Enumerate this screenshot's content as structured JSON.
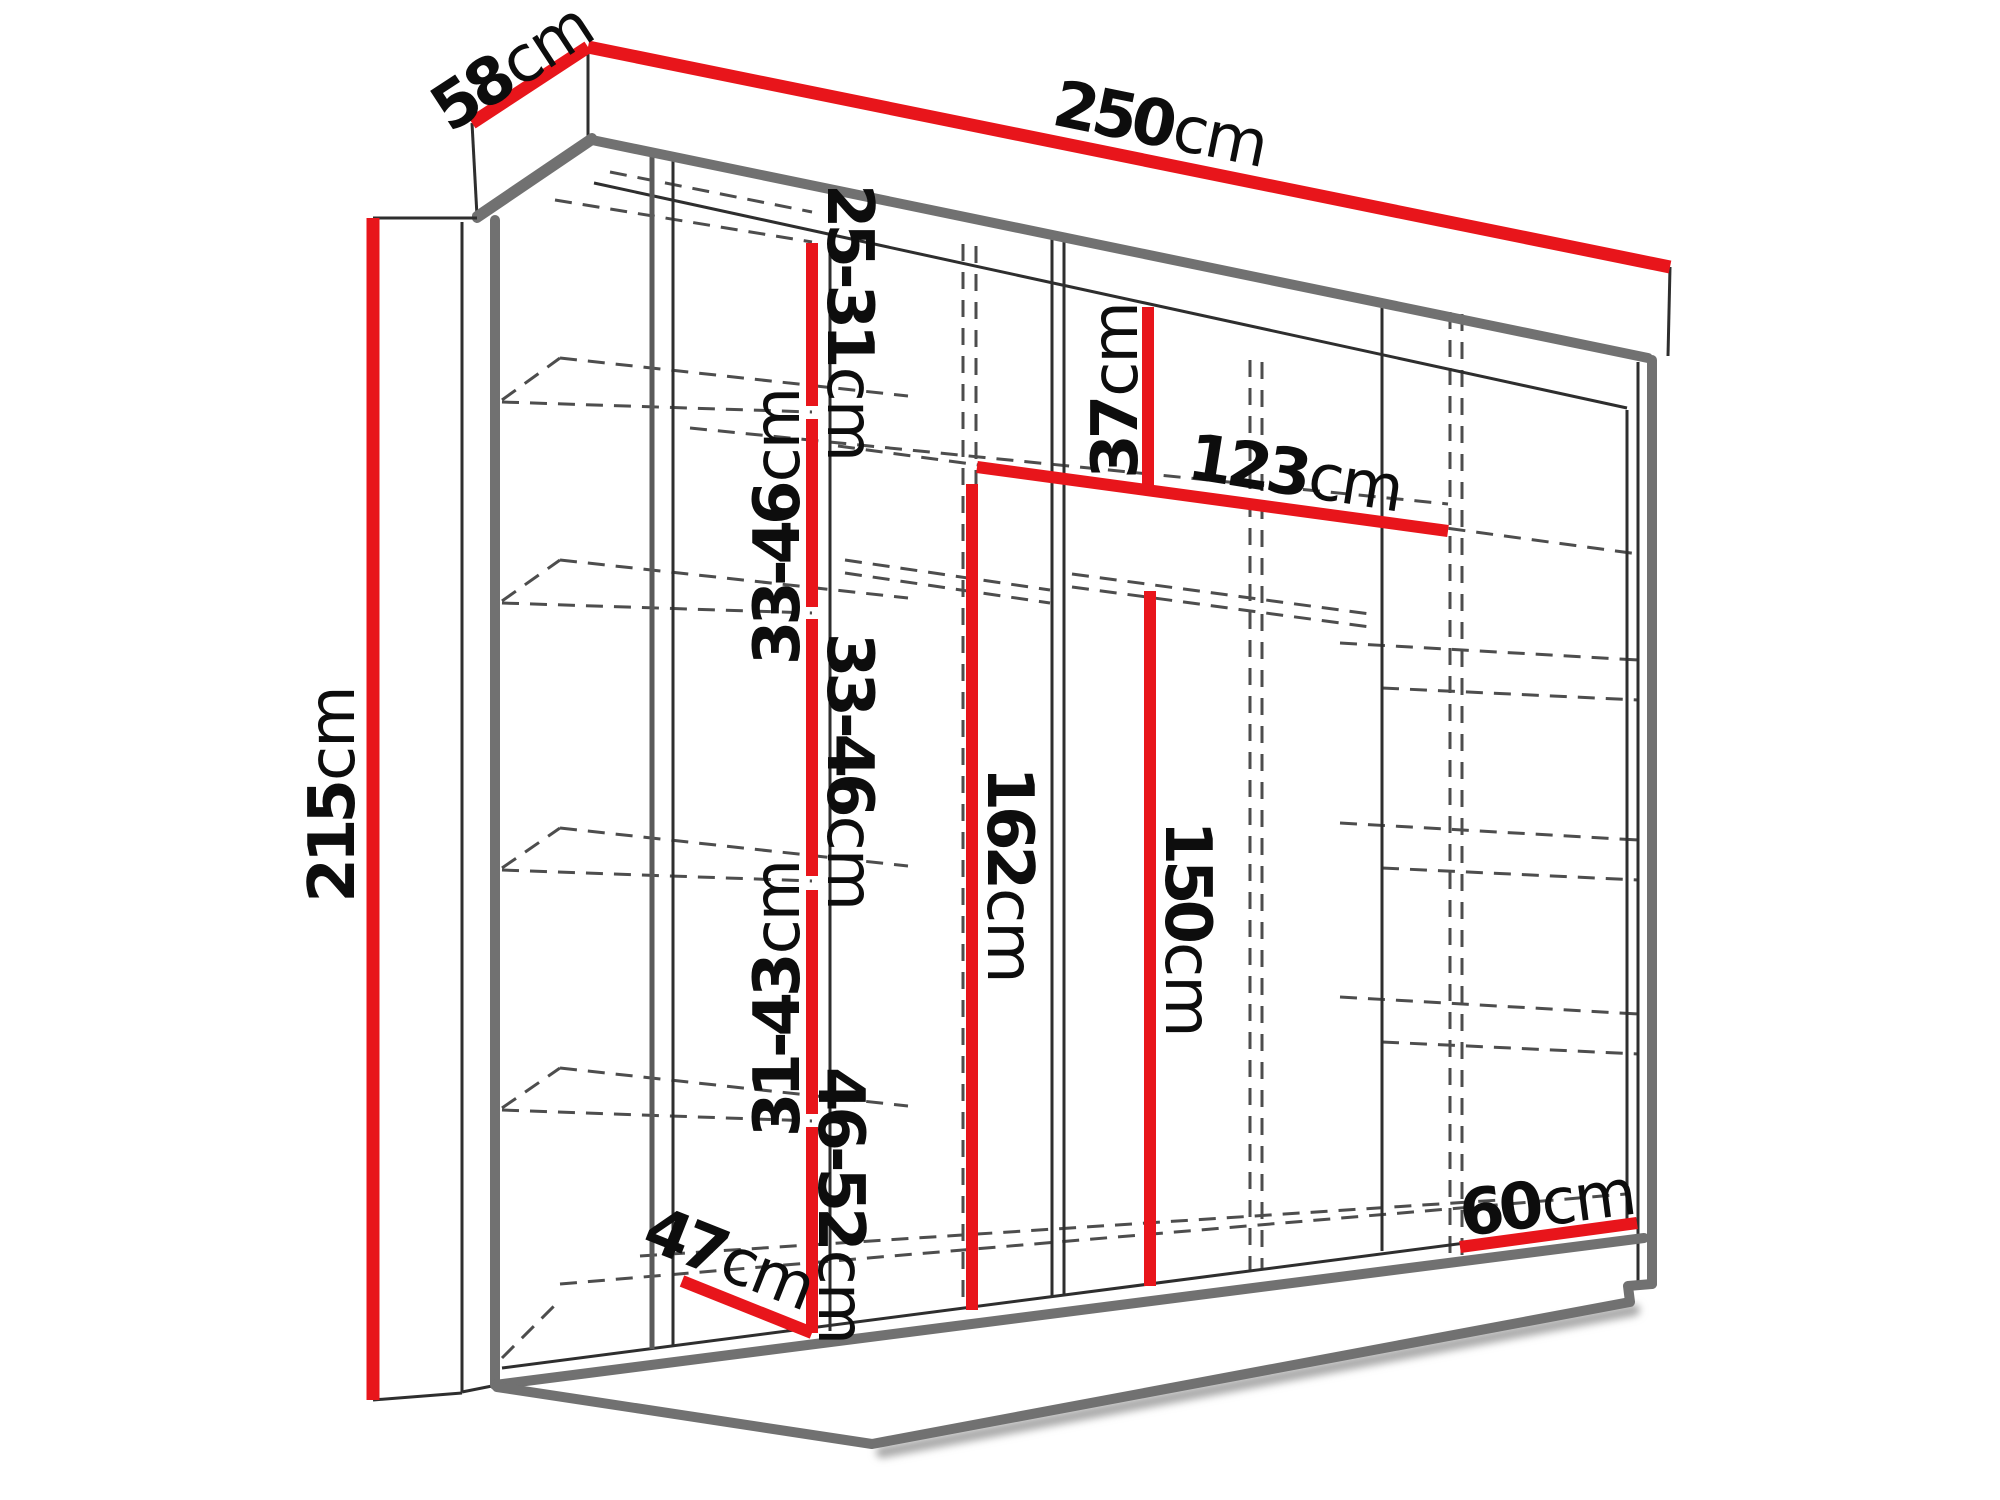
{
  "title": "Sliding wardrobe dimension diagram",
  "unit": "cm",
  "colors": {
    "dimension_line": "#e8151b",
    "structure_thick": "#717171",
    "structure_thin": "#2e2e2e",
    "dashed_line": "#4d4d4d",
    "label_text": "#0d0d0d",
    "background": "#ffffff"
  },
  "dims": {
    "top_depth": {
      "value": "58",
      "unit": "cm"
    },
    "top_width": {
      "value": "250",
      "unit": "cm"
    },
    "side_height": {
      "value": "215",
      "unit": "cm"
    },
    "left_gap_1": {
      "value": "25-31",
      "unit": "cm"
    },
    "left_gap_2": {
      "value": "33-46",
      "unit": "cm"
    },
    "left_gap_3": {
      "value": "33-46",
      "unit": "cm"
    },
    "left_gap_4": {
      "value": "31-43",
      "unit": "cm"
    },
    "left_gap_5": {
      "value": "46-52",
      "unit": "cm"
    },
    "middle_top_gap": {
      "value": "37",
      "unit": "cm"
    },
    "middle_shelf_width": {
      "value": "123",
      "unit": "cm"
    },
    "inner_height_left": {
      "value": "162",
      "unit": "cm"
    },
    "inner_height_right": {
      "value": "150",
      "unit": "cm"
    },
    "bottom_depth_left": {
      "value": "47",
      "unit": "cm"
    },
    "bottom_width_right": {
      "value": "60",
      "unit": "cm"
    }
  }
}
